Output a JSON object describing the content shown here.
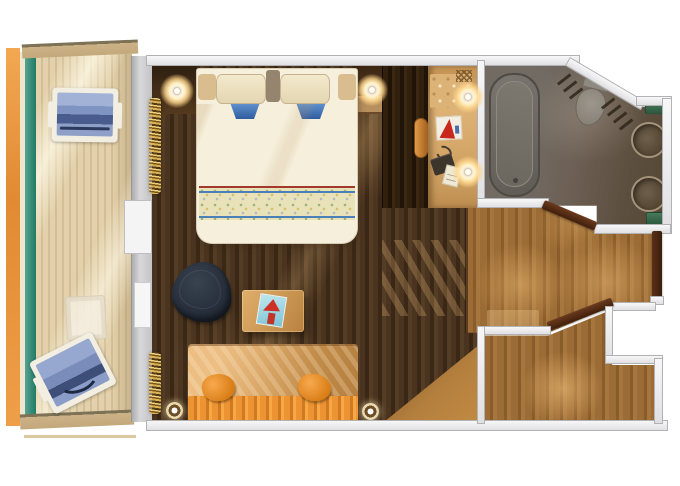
{
  "title": "Cruise ship suite floor plan",
  "canvas": {
    "width": 680,
    "height": 486
  },
  "palette": {
    "background": "#ffffff",
    "wall_light": "#ececee",
    "wall_gray": "#c9c9cb",
    "balcony_orange": "#e9953f",
    "balcony_teal": "#2f8c78",
    "deck_wood": "#e0cda6",
    "cabin_floor": "#46311d",
    "corridor_floor": "#9c6c36",
    "bathroom_floor": "#665948",
    "tub_gray": "#6b6763",
    "bed_linen": "#f6efdb",
    "pillow_blue": "#4a7fc1",
    "sofa_orange": "#e08a2e",
    "sofa_back": "#d9a768",
    "armchair_navy": "#2a3240",
    "door_brown": "#4a2817",
    "towel_green": "#3c6b4e",
    "lamp_glow": "#ffe9b8",
    "accent_red": "#c8271c"
  },
  "rooms": {
    "balcony": {
      "name": "Balcony",
      "furniture": [
        "lounge chair",
        "lounge chair",
        "side table"
      ]
    },
    "cabin": {
      "name": "Bedroom and living area",
      "furniture": [
        "king bed",
        "nightstands with lamps",
        "armchair",
        "desk with magazine",
        "sofa with pillows",
        "vanity with stool",
        "wardrobe"
      ]
    },
    "bathroom": {
      "name": "Bathroom",
      "furniture": [
        "bathtub",
        "toilet",
        "double sinks",
        "towels"
      ]
    },
    "entry": {
      "name": "Entry hall",
      "furniture": [
        "entry door",
        "interior door"
      ]
    }
  }
}
